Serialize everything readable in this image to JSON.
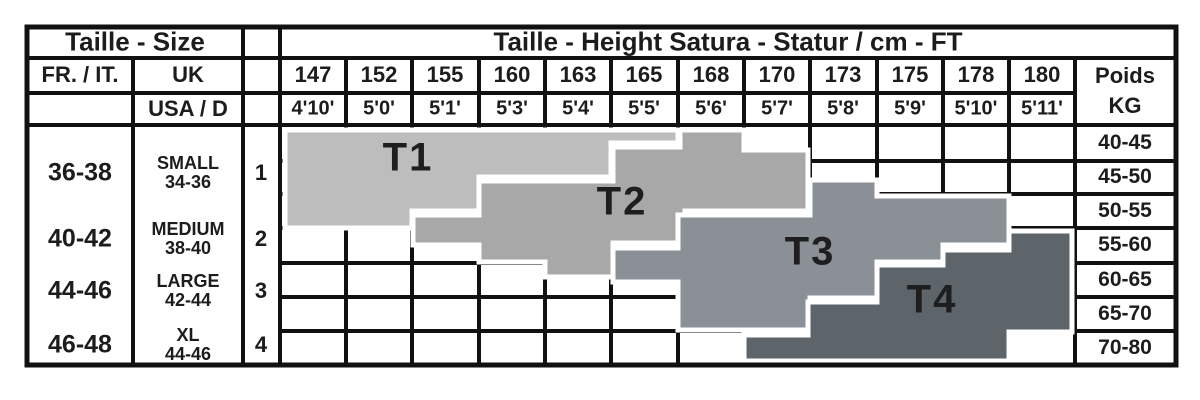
{
  "header": {
    "size_title": "Taille - Size",
    "height_title": "Taille - Height Satura - Statur / cm - FT",
    "fr_it_label": "FR. / IT.",
    "uk_label": "UK",
    "usa_d_label": "USA / D",
    "weight_title": "Poids",
    "weight_unit": "KG"
  },
  "heights_cm": [
    "147",
    "152",
    "155",
    "160",
    "163",
    "165",
    "168",
    "170",
    "173",
    "175",
    "178",
    "180"
  ],
  "heights_ft": [
    "4'10'",
    "5'0'",
    "5'1'",
    "5'3'",
    "5'4'",
    "5'5'",
    "5'6'",
    "5'7'",
    "5'8'",
    "5'9'",
    "5'10'",
    "5'11'"
  ],
  "weights_kg": [
    "40-45",
    "45-50",
    "50-55",
    "55-60",
    "60-65",
    "65-70",
    "70-80"
  ],
  "sizes": [
    {
      "fr_it": "36-38",
      "uk_name": "SMALL",
      "uk_range": "34-36",
      "usa_d": "1"
    },
    {
      "fr_it": "40-42",
      "uk_name": "MEDIUM",
      "uk_range": "38-40",
      "usa_d": "2"
    },
    {
      "fr_it": "44-46",
      "uk_name": "LARGE",
      "uk_range": "42-44",
      "usa_d": "3"
    },
    {
      "fr_it": "46-48",
      "uk_name": "XL",
      "uk_range": "44-46",
      "usa_d": "4"
    }
  ],
  "bands": [
    {
      "label": "T1",
      "color": "#bdbdbd",
      "points": "285,130 678,130 678,143 611,143 611,177 479,177 479,211 412,211 412,228 285,228"
    },
    {
      "label": "T2",
      "color": "#a8a8a8",
      "points": "413,215 479,215 479,181 613,181 613,147 680,147 680,130 744,130 744,150 808,150 808,211 685,211 685,243 613,243 613,277 545,277 545,262 479,262 479,245 413,245"
    },
    {
      "label": "T3",
      "color": "#8a9096",
      "points": "613,248 678,248 678,215 810,215 810,180 877,180 877,196 1009,196 1009,245 943,245 943,262 877,262 877,298 810,298 810,330 678,330 678,282 613,282"
    },
    {
      "label": "T4",
      "color": "#5d656b",
      "points": "1009,231 1072,231 1072,332 1009,332 1009,361 744,361 744,335 808,335 808,302 877,302 877,265 943,265 943,250 1009,250"
    }
  ],
  "chart_data": {
    "type": "table",
    "title": "Taille - Height Satura - Statur / cm - FT",
    "columns_height_cm": [
      147,
      152,
      155,
      160,
      163,
      165,
      168,
      170,
      173,
      175,
      178,
      180
    ],
    "columns_height_ft": [
      "4'10'",
      "5'0'",
      "5'1'",
      "5'3'",
      "5'4'",
      "5'5'",
      "5'6'",
      "5'7'",
      "5'8'",
      "5'9'",
      "5'10'",
      "5'11'"
    ],
    "rows_weight_kg": [
      "40-45",
      "45-50",
      "50-55",
      "55-60",
      "60-65",
      "65-70",
      "70-80"
    ],
    "size_rows": [
      {
        "fr_it": "36-38",
        "uk": "SMALL 34-36",
        "usa_d": "1"
      },
      {
        "fr_it": "40-42",
        "uk": "MEDIUM 38-40",
        "usa_d": "2"
      },
      {
        "fr_it": "44-46",
        "uk": "LARGE 42-44",
        "usa_d": "3"
      },
      {
        "fr_it": "46-48",
        "uk": "XL 44-46",
        "usa_d": "4"
      }
    ],
    "bands": [
      {
        "label": "T1",
        "approx_height_range_cm": "147-165",
        "approx_weight_range_kg": "40-55"
      },
      {
        "label": "T2",
        "approx_height_range_cm": "155-170",
        "approx_weight_range_kg": "40-65"
      },
      {
        "label": "T3",
        "approx_height_range_cm": "163-178",
        "approx_weight_range_kg": "45-70"
      },
      {
        "label": "T4",
        "approx_height_range_cm": "170-180",
        "approx_weight_range_kg": "50-80"
      }
    ],
    "legend_position": "labels-inside-bands",
    "grid": true
  }
}
